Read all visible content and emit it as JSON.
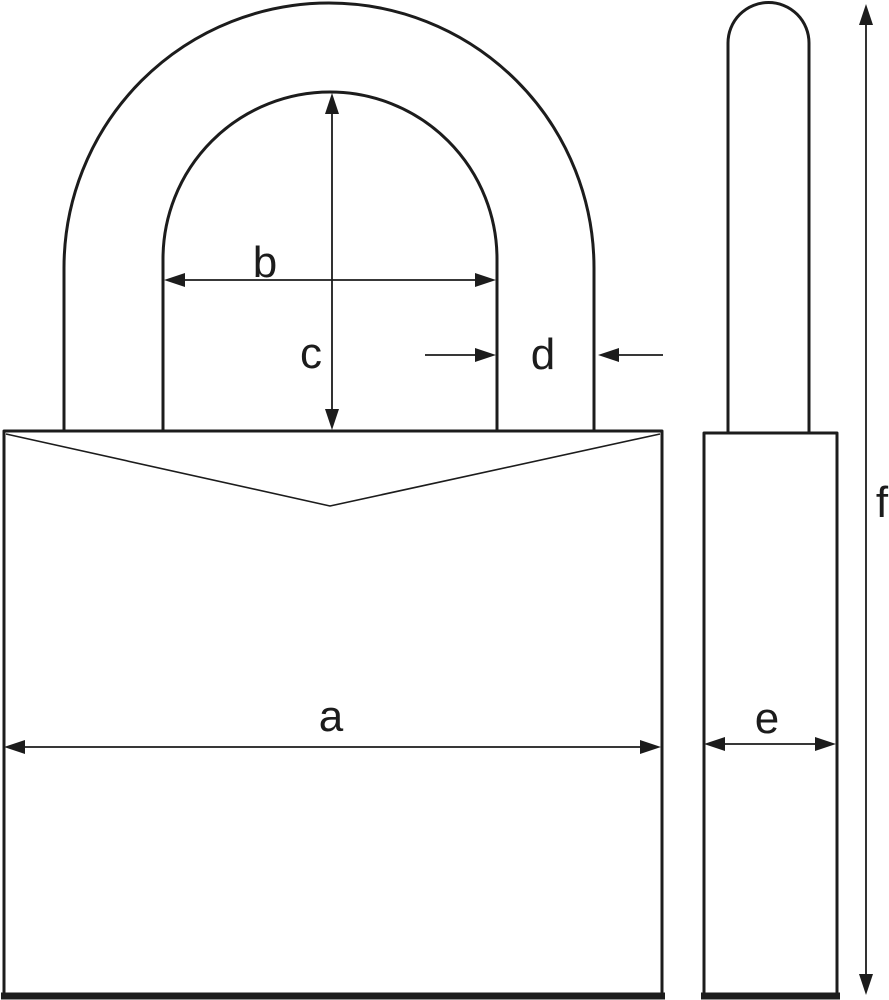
{
  "colors": {
    "line": "#1c1c1c",
    "background": "#ffffff"
  },
  "dimension_labels": {
    "a": "a",
    "b": "b",
    "c": "c",
    "d": "d",
    "e": "e",
    "f": "f"
  }
}
